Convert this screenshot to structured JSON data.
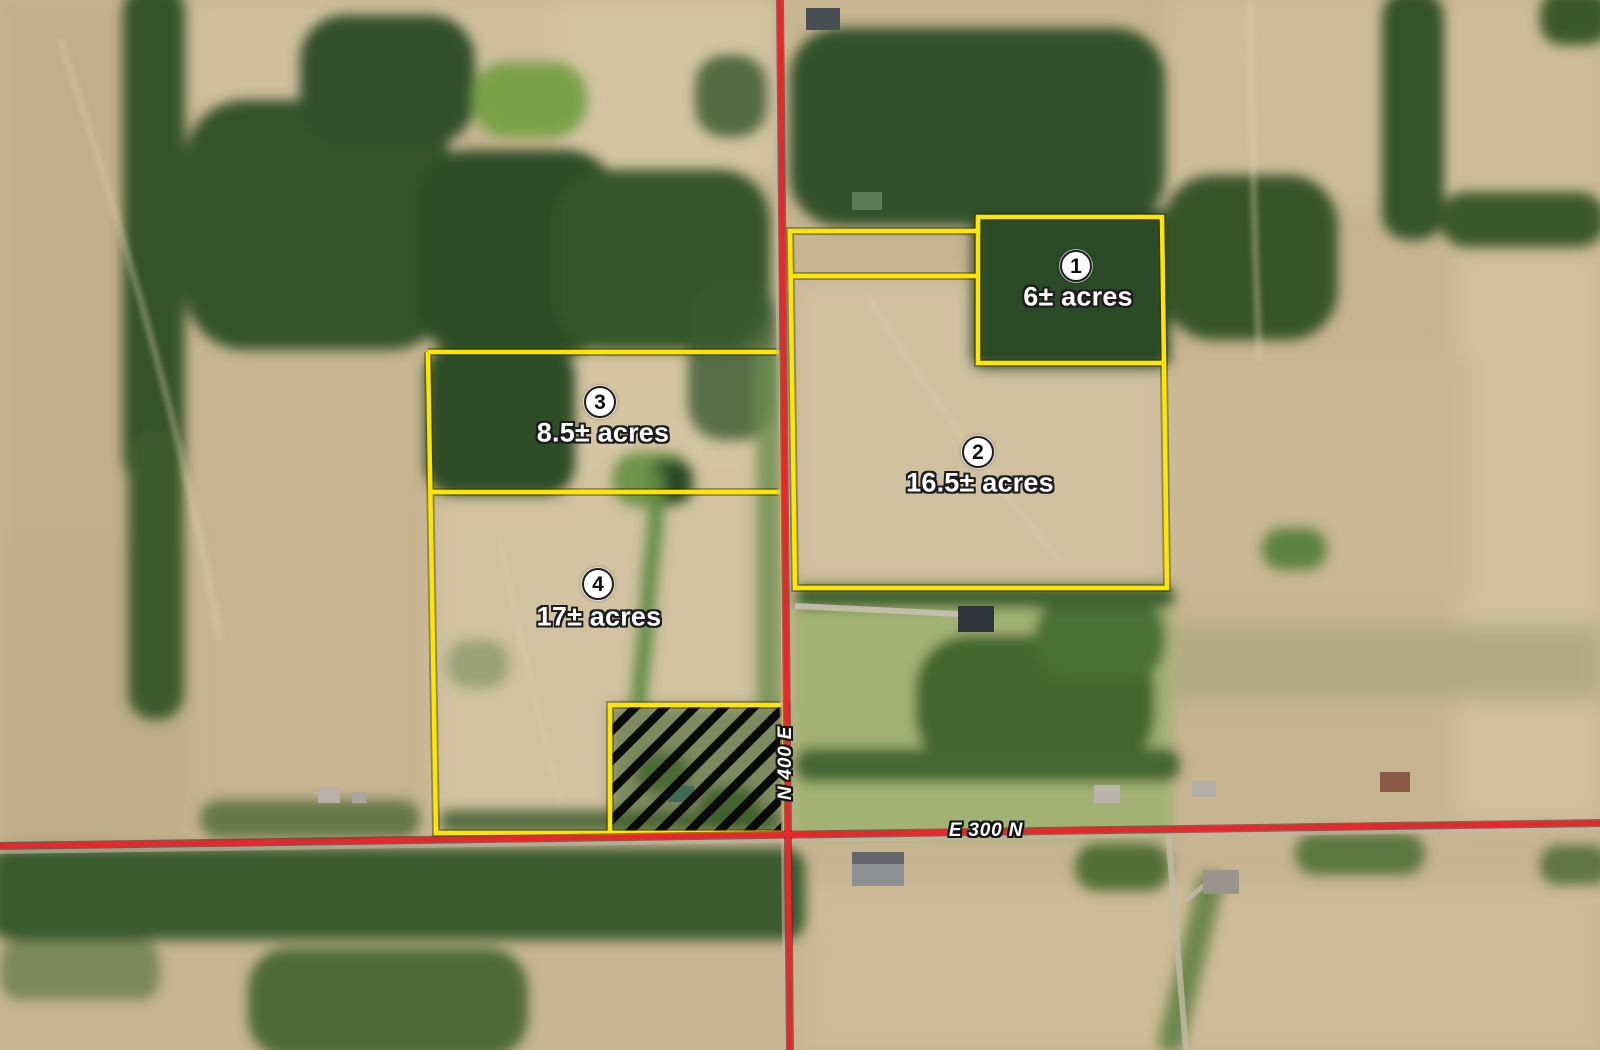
{
  "map": {
    "description": "aerial-parcel-auction-map",
    "parcels": [
      {
        "number": "1",
        "acreage": "6± acres"
      },
      {
        "number": "2",
        "acreage": "16.5± acres"
      },
      {
        "number": "3",
        "acreage": "8.5± acres"
      },
      {
        "number": "4",
        "acreage": "17± acres"
      }
    ],
    "roads": [
      {
        "name": "N 400 E",
        "orientation": "vertical"
      },
      {
        "name": "E 300 N",
        "orientation": "horizontal"
      }
    ],
    "colors": {
      "parcel_outline": "#ffe600",
      "road_line": "#e8262d",
      "hatch_stripes": "#0a0a0a",
      "marker_fill": "#ffffff",
      "marker_number": "#0a0a0a",
      "label_text": "#ffffff",
      "label_outline": "#1c1c1c"
    }
  }
}
